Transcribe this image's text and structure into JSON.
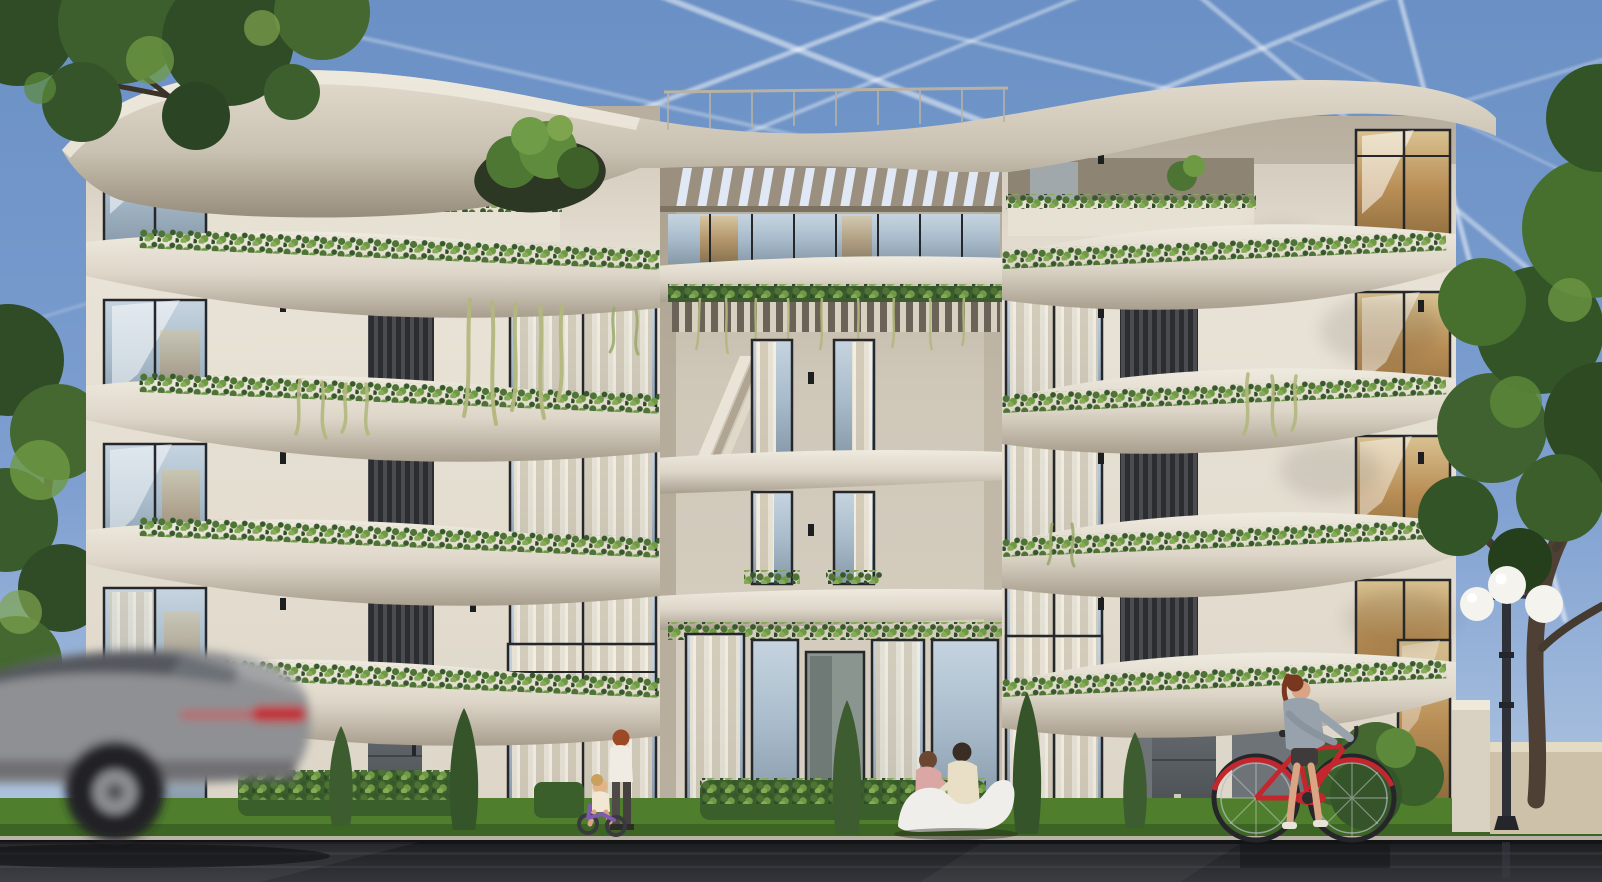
{
  "scene": {
    "type": "architectural-exterior-rendering",
    "description": "Street-level rendering of a modern five-storey apartment building with sweeping curved white concrete slabs, planted balcony edges, dark louver panels, a recessed central pergola bay, wet asphalt road with a motion-blurred grey car, children on the sidewalk, a couple on a white sculptural bench, a woman walking a red bicycle, a triple-globe lamppost and framing trees under a blue sky crossed by contrails",
    "time_of_day": "day",
    "sky": {
      "condition": "clear with jet contrails",
      "contrail_count": 12
    },
    "building": {
      "floors": 5,
      "style": "organic curved slab architecture",
      "features": [
        "curved white concrete floor slabs",
        "planter strips with trailing vines on slab edges",
        "floor-to-ceiling glazing with cream curtains",
        "dark vertical louver panels",
        "central recessed bay with slatted pergola roof",
        "rooftop cutout with tree",
        "terrace parapets with plants",
        "wall sconces"
      ]
    },
    "street_elements": [
      "wet asphalt road",
      "grass verge",
      "concrete curb",
      "boxwood hedges",
      "cypress trees",
      "entrance doors",
      "white sculptural bench",
      "triple-globe lamppost",
      "low boundary wall",
      "bollard light"
    ],
    "people": [
      {
        "name": "child-standing"
      },
      {
        "name": "toddler-on-balance-bike"
      },
      {
        "name": "couple-seated-on-bench"
      },
      {
        "name": "woman-walking-bicycle"
      }
    ],
    "vehicles": [
      {
        "name": "grey-car-motion-blurred"
      },
      {
        "name": "red-city-bicycle"
      }
    ]
  },
  "colors": {
    "sky_top": "#6a90c5",
    "sky_horizon": "#b9cde4",
    "contrail": "#ffffff",
    "concrete_light": "#e9e3d7",
    "concrete_mid": "#d3ccbe",
    "concrete_shadow": "#a89e8e",
    "wall_recess": "#c6bdae",
    "glass_blue": "#a9bccb",
    "glass_amber": "#b98e55",
    "curtain": "#ece4d3",
    "frame_dark": "#26272a",
    "louver": "#36383b",
    "foliage_dark": "#2f4c27",
    "foliage_mid": "#4d7434",
    "foliage_light": "#7fa44e",
    "vine_pale": "#b3b87e",
    "grass": "#4f7f2c",
    "hedge": "#3a5f2a",
    "road": "#232428",
    "curb": "#b8b3a5",
    "car_grey": "#8f9093",
    "taillight": "#c22f36",
    "bicycle_red": "#c4262d",
    "bench_white": "#f0eeea",
    "lamp_globe": "#f5f3ee",
    "lamp_pole": "#2e3138",
    "skin": "#d9a584",
    "trunk": "#4e4034"
  }
}
